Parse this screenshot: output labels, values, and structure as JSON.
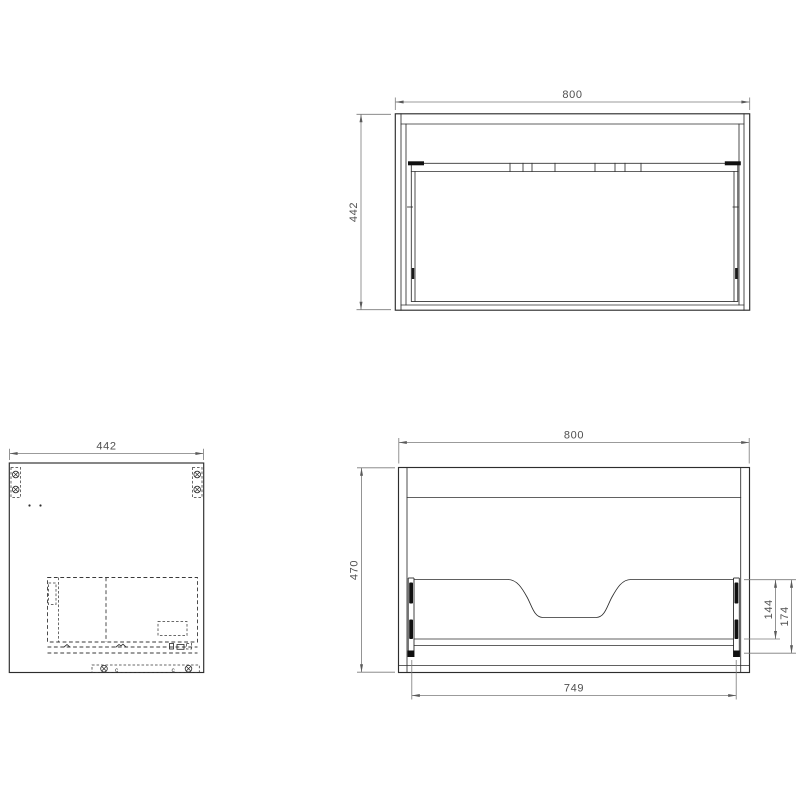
{
  "document": {
    "type": "technical-drawing",
    "background": "#ffffff",
    "object_line_color": "#2d2d2d",
    "hidden_line_color": "#3a3a3a",
    "dimension_line_color": "#7a7a7a",
    "dimension_text_color": "#4f4f4f"
  },
  "views": {
    "top": {
      "name": "cabinet-top-view",
      "dimensions": {
        "width": "800",
        "depth": "442"
      }
    },
    "side": {
      "name": "cabinet-side-view",
      "dimensions": {
        "depth": "442"
      },
      "clip_marks": [
        "c",
        "c"
      ]
    },
    "front": {
      "name": "cabinet-front-view",
      "dimensions": {
        "width": "800",
        "height": "470",
        "opening_width": "749",
        "back_panel_height": "144",
        "back_assembly_height": "174"
      }
    }
  }
}
